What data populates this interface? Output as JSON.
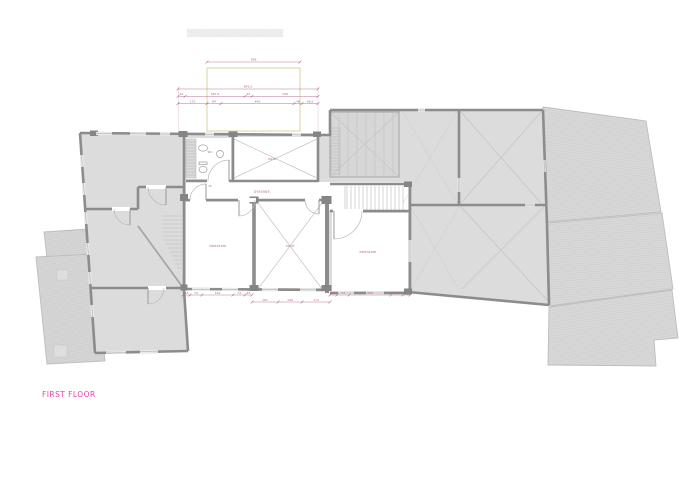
{
  "title": "FIRST FLOOR",
  "labels": {
    "wc": "wc",
    "void_upper": "void",
    "passage": "passage",
    "bedroom_left": "bedroom",
    "void_lower": "void",
    "bedroom_right": "bedroom",
    "door_width": "90"
  },
  "dimensions": {
    "top": "588",
    "overall": "843,5",
    "row1": [
      "42",
      "361,5",
      "42",
      "398"
    ],
    "row2": [
      "175",
      "84",
      "440",
      "48",
      "96,5"
    ],
    "bedroom_left": [
      "43",
      "74",
      "192",
      "74",
      "43"
    ],
    "void_lower": [
      "161",
      "149",
      "174"
    ],
    "bedroom_right": [
      "43",
      "74",
      "260",
      "74",
      "43"
    ]
  },
  "colors": {
    "dimension_pink": "#b3638f",
    "title_pink": "#ee3f9e",
    "wall_gray": "#8c8c8c",
    "room_fill": "#dcdcdc",
    "roof_fill": "#d8d8d8",
    "highlight_yellow": "#d8d09a"
  }
}
